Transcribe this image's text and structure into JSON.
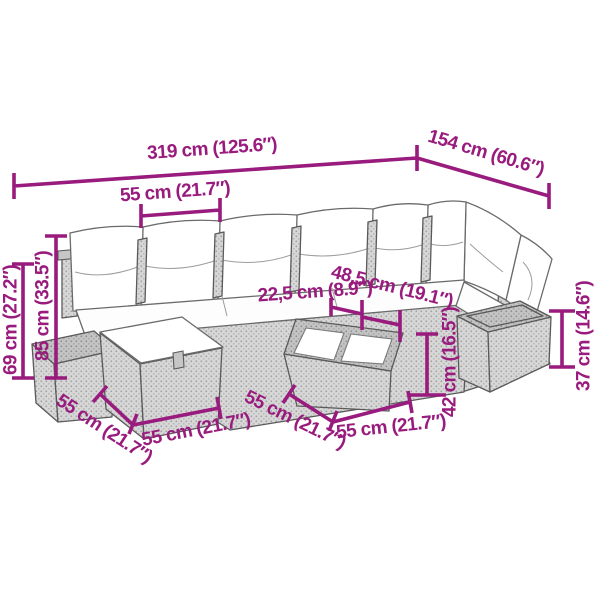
{
  "diagram": {
    "type": "furniture-dimension-diagram",
    "subject": "8-piece poly rattan garden lounge set with cushions, footstools and glass-top table",
    "background_color": "#ffffff",
    "accent_color": "#981b7d",
    "outline_color": "#5a5a5a",
    "cushion_color": "#ffffff",
    "rattan_color": "#d7d7d7"
  },
  "annotations": [
    {
      "name": "total-width",
      "text": "319 cm (125.6″)"
    },
    {
      "name": "return-depth",
      "text": "154 cm (60.6″)"
    },
    {
      "name": "module-width",
      "text": "55 cm (21.7″)"
    },
    {
      "name": "arm-height",
      "text": "69 cm (27.2″)"
    },
    {
      "name": "back-height",
      "text": "85 cm (33.5″)"
    },
    {
      "name": "cushion-thickness",
      "text": "22,5 cm (8.9″)"
    },
    {
      "name": "seat-depth",
      "text": "48,5 cm (19.1″)"
    },
    {
      "name": "table-height",
      "text": "42 cm (16.5″)"
    },
    {
      "name": "stool-height",
      "text": "37 cm (14.6″)"
    },
    {
      "name": "footstool-side",
      "text": "55 cm (21.7″)"
    },
    {
      "name": "footstool-front",
      "text": "55 cm (21.7″)"
    },
    {
      "name": "table-side",
      "text": "55 cm (21.7″)"
    },
    {
      "name": "table-front",
      "text": "55 cm (21.7″)"
    }
  ]
}
